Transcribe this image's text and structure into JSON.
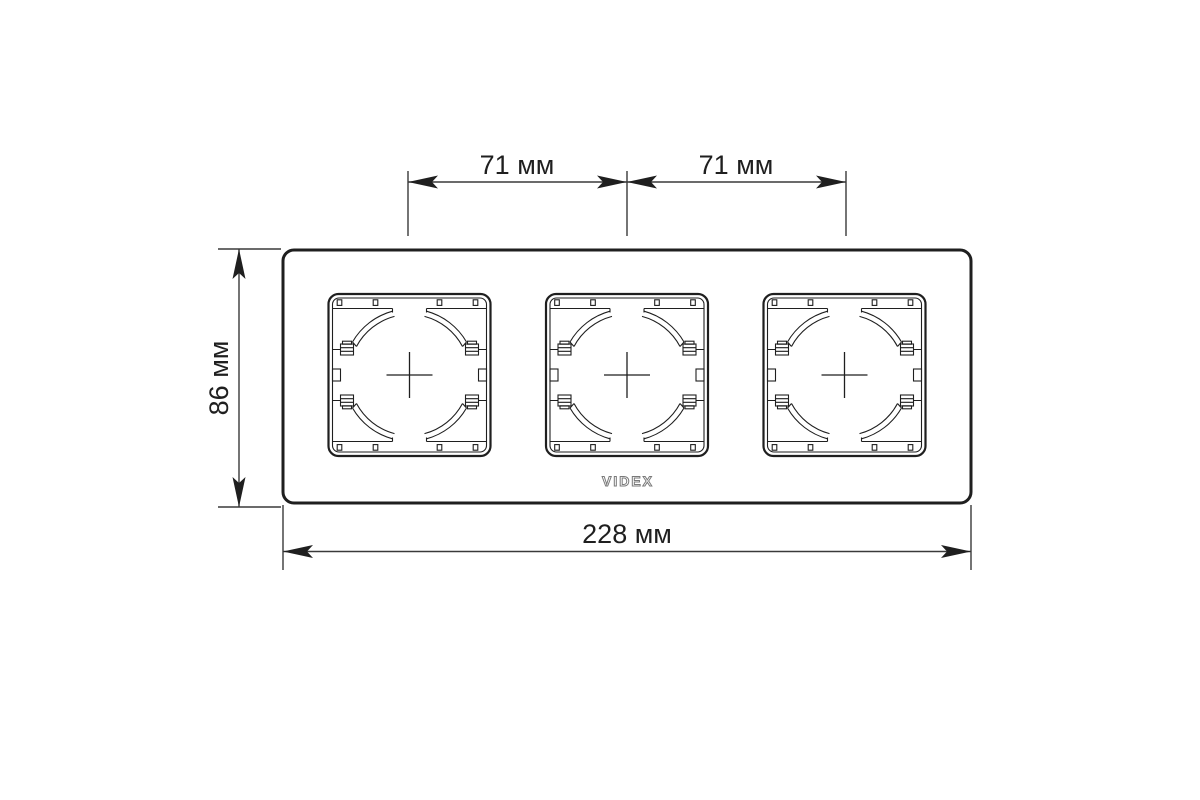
{
  "drawing": {
    "brand": "VIDEX",
    "labels": {
      "span_left": "71 мм",
      "span_right": "71 мм",
      "height": "86 мм",
      "width": "228 мм"
    },
    "colors": {
      "line": "#1f1f1f",
      "dimension_line": "#3a3a3a",
      "background": "#ffffff",
      "logo_outline": "#7a7a7a"
    }
  }
}
